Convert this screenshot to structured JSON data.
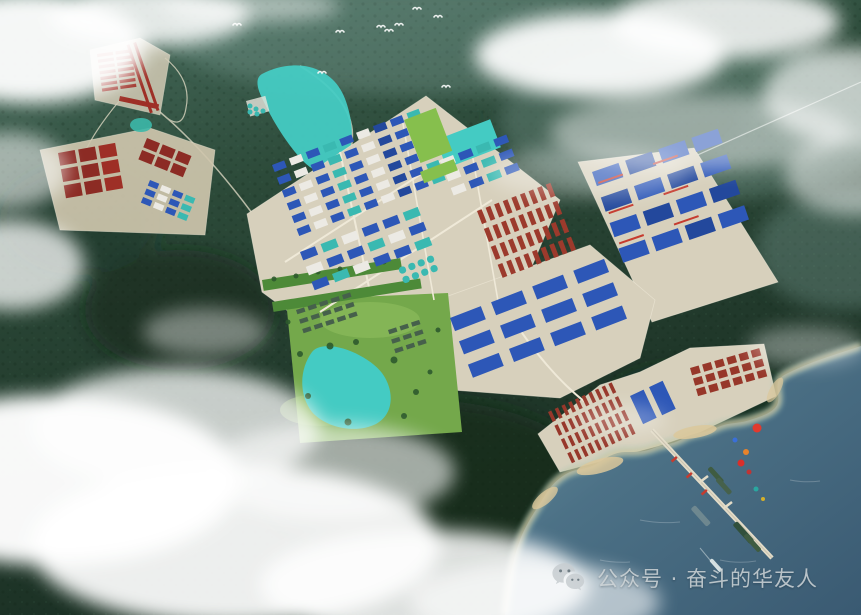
{
  "scene": {
    "type": "aerial-masterplan-rendering",
    "setting": "coastal industrial park among forested mountains with mist, reservoir, mine site, workers camp, living park, port stockyards, jetty with ships, and open sea"
  },
  "watermark": {
    "icon": "wechat-icon",
    "text": "公众号 · 奋斗的华友人"
  },
  "palette": {
    "ground": "#d7d0bc",
    "road": "#efe9d8",
    "lake": "#44cbc3",
    "sea": "#4c7186",
    "roofBlue": "#2d57b7",
    "roofBlueDark": "#23489c",
    "roofWhite": "#eceae4",
    "roofRed": "#9e2f26",
    "mineRed": "#8c2b24",
    "dormRed": "#9c3a2c",
    "stockRed": "#97372a",
    "tankTeal": "#3ab9b1",
    "fieldGreen": "#86bf4d",
    "parkGreen": "#74a84b",
    "beltGreen": "#4d8a38",
    "houseGray": "#46604b",
    "craneRed": "#c63b2e",
    "beach": "#dcc89b",
    "mist": "#ffffff",
    "bird": "#f5f8f7"
  },
  "zones": [
    {
      "name": "camp-barracks",
      "x": 97,
      "y": 54,
      "rot": -8,
      "rows": 7,
      "cols": 2,
      "w": 16,
      "h": 3.2,
      "gx": 2.5,
      "gy": 2.6,
      "colors": [
        "roofRed"
      ]
    },
    {
      "name": "camp-long-buildings",
      "x": 136,
      "y": 42,
      "rot": 71,
      "rows": 2,
      "cols": 1,
      "w": 72,
      "h": 3,
      "gx": 0,
      "gy": 4,
      "colors": [
        "roofRed"
      ]
    },
    {
      "name": "camp-lower-building",
      "x": 120,
      "y": 96,
      "rot": 12,
      "rows": 1,
      "cols": 1,
      "w": 40,
      "h": 5,
      "gx": 0,
      "gy": 0,
      "colors": [
        "roofRed"
      ]
    },
    {
      "name": "mine-ore-plots-west",
      "x": 58,
      "y": 153,
      "rot": -10,
      "rows": 3,
      "cols": 3,
      "w": 17,
      "h": 13,
      "gx": 3.5,
      "gy": 3.5,
      "colors": [
        "mineRed",
        "mineRed",
        "roofRed"
      ]
    },
    {
      "name": "mine-ore-plots-north",
      "x": 147,
      "y": 138,
      "rot": 22,
      "rows": 2,
      "cols": 3,
      "w": 14,
      "h": 10,
      "gx": 3,
      "gy": 3,
      "colors": [
        "mineRed"
      ]
    },
    {
      "name": "mine-process-buildings",
      "x": 150,
      "y": 180,
      "rot": 22,
      "rows": 3,
      "cols": 4,
      "w": 10,
      "h": 6,
      "gx": 3,
      "gy": 3.2,
      "colors": [
        "roofBlue",
        "roofWhite",
        "roofBlue",
        "tankTeal"
      ]
    },
    {
      "name": "park-northwest-buildings",
      "x": 272,
      "y": 165,
      "rot": -21,
      "rows": 6,
      "cols": 9,
      "w": 13,
      "h": 7.5,
      "gx": 5,
      "gy": 6.2,
      "colors": [
        "roofBlue",
        "roofWhite",
        "roofBlue",
        "tankTeal",
        "roofBlue",
        "roofWhite",
        "roofBlueDark",
        "roofBlue",
        "tankTeal"
      ]
    },
    {
      "name": "park-northeast-buildings",
      "x": 440,
      "y": 160,
      "rot": -21,
      "rows": 3,
      "cols": 4,
      "w": 14,
      "h": 8,
      "gx": 5,
      "gy": 7,
      "colors": [
        "roofWhite",
        "roofBlue",
        "tankTeal",
        "roofBlue"
      ]
    },
    {
      "name": "park-midwest-buildings",
      "x": 300,
      "y": 252,
      "rot": -21,
      "rows": 3,
      "cols": 6,
      "w": 16,
      "h": 9,
      "gx": 6,
      "gy": 7,
      "colors": [
        "roofBlue",
        "tankTeal",
        "roofWhite",
        "roofBlue"
      ]
    },
    {
      "name": "tank-cluster",
      "x": 398,
      "y": 268,
      "rot": -21,
      "rows": 2,
      "cols": 4,
      "w": 7,
      "h": 7,
      "gx": 3,
      "gy": 3,
      "rx": 3,
      "colors": [
        "tankTeal"
      ]
    },
    {
      "name": "dormitory-block",
      "x": 477,
      "y": 211,
      "rot": -21,
      "rows": 4,
      "cols": 9,
      "w": 5,
      "h": 14,
      "gx": 4.2,
      "gy": 5.2,
      "colors": [
        "dormRed"
      ]
    },
    {
      "name": "south-warehouses",
      "x": 450,
      "y": 318,
      "rot": -21,
      "rows": 3,
      "cols": 4,
      "w": 33,
      "h": 14,
      "gx": 11,
      "gy": 11,
      "colors": [
        "roofBlue"
      ]
    },
    {
      "name": "east-plant-buildings",
      "x": 592,
      "y": 172,
      "rot": -19,
      "rows": 4,
      "cols": 4,
      "w": 28,
      "h": 15,
      "gx": 7,
      "gy": 12,
      "colors": [
        "roofBlue",
        "roofBlueDark",
        "roofBlue",
        "roofBlue",
        "roofBlueDark"
      ]
    },
    {
      "name": "east-plant-cranes",
      "x": 598,
      "y": 182,
      "rot": -19,
      "rows": 3,
      "cols": 2,
      "w": 26,
      "h": 2,
      "gx": 32,
      "gy": 30,
      "colors": [
        "craneRed"
      ]
    },
    {
      "name": "living-park-houses-west",
      "x": 296,
      "y": 310,
      "rot": -18,
      "rows": 3,
      "cols": 5,
      "w": 8.5,
      "h": 4.5,
      "gx": 3.6,
      "gy": 5.5,
      "colors": [
        "houseGray"
      ]
    },
    {
      "name": "living-park-houses-east",
      "x": 388,
      "y": 330,
      "rot": -18,
      "rows": 3,
      "cols": 3,
      "w": 8.5,
      "h": 4.5,
      "gx": 3.6,
      "gy": 5.5,
      "colors": [
        "houseGray"
      ]
    },
    {
      "name": "port-stock-rows-west",
      "x": 548,
      "y": 412,
      "rot": -25,
      "rows": 4,
      "cols": 10,
      "w": 3.6,
      "h": 11,
      "gx": 3.8,
      "gy": 4.2,
      "colors": [
        "stockRed"
      ]
    },
    {
      "name": "port-stock-rows-east",
      "x": 690,
      "y": 368,
      "rot": -16,
      "rows": 3,
      "cols": 6,
      "w": 9,
      "h": 7.5,
      "gx": 3.6,
      "gy": 3.4,
      "colors": [
        "stockRed"
      ]
    },
    {
      "name": "port-warehouses",
      "x": 630,
      "y": 396,
      "rot": -25,
      "rows": 1,
      "cols": 2,
      "w": 15,
      "h": 31,
      "gx": 6,
      "gy": 0,
      "colors": [
        "roofBlue"
      ]
    },
    {
      "name": "green-field-strip",
      "x": 404,
      "y": 120,
      "rot": -21,
      "rows": 1,
      "cols": 1,
      "w": 34,
      "h": 46,
      "gx": 0,
      "gy": 0,
      "colors": [
        "fieldGreen"
      ]
    },
    {
      "name": "green-field-south",
      "x": 420,
      "y": 172,
      "rot": -21,
      "rows": 1,
      "cols": 1,
      "w": 36,
      "h": 12,
      "gx": 0,
      "gy": 0,
      "colors": [
        "fieldGreen"
      ]
    }
  ],
  "birds": [
    [
      237,
      25
    ],
    [
      322,
      73
    ],
    [
      340,
      32
    ],
    [
      381,
      27
    ],
    [
      389,
      31
    ],
    [
      399,
      25
    ],
    [
      417,
      9
    ],
    [
      438,
      17
    ],
    [
      446,
      87
    ]
  ],
  "jetty_cranes": [
    [
      676,
      456
    ],
    [
      691,
      472
    ],
    [
      706,
      489
    ]
  ],
  "jetty_markers": [
    {
      "x": 757,
      "y": 428,
      "r": 4.5,
      "c": "#e23a2e"
    },
    {
      "x": 746,
      "y": 452,
      "r": 3,
      "c": "#e8832a"
    },
    {
      "x": 741,
      "y": 463,
      "r": 3.5,
      "c": "#d92f2a"
    },
    {
      "x": 749,
      "y": 472,
      "r": 2.5,
      "c": "#c03434"
    },
    {
      "x": 756,
      "y": 489,
      "r": 2.5,
      "c": "#2aa7a0"
    },
    {
      "x": 763,
      "y": 499,
      "r": 2,
      "c": "#d4b02a"
    },
    {
      "x": 735,
      "y": 440,
      "r": 2.5,
      "c": "#3a6fd8"
    }
  ],
  "ships": [
    {
      "x": 711,
      "y": 466,
      "w": 20,
      "h": 5,
      "c": "#3f5c41"
    },
    {
      "x": 719,
      "y": 477,
      "w": 20,
      "h": 5,
      "c": "#46614b"
    },
    {
      "x": 695,
      "y": 505,
      "w": 24,
      "h": 6,
      "c": "#8fa09c",
      "o": 0.55
    },
    {
      "x": 737,
      "y": 521,
      "w": 26,
      "h": 6,
      "c": "#31503c"
    },
    {
      "x": 747,
      "y": 533,
      "w": 22,
      "h": 5,
      "c": "#3f5c41"
    },
    {
      "x": 712,
      "y": 558,
      "w": 16,
      "h": 4,
      "c": "#e3ecec",
      "o": 0.9
    }
  ]
}
